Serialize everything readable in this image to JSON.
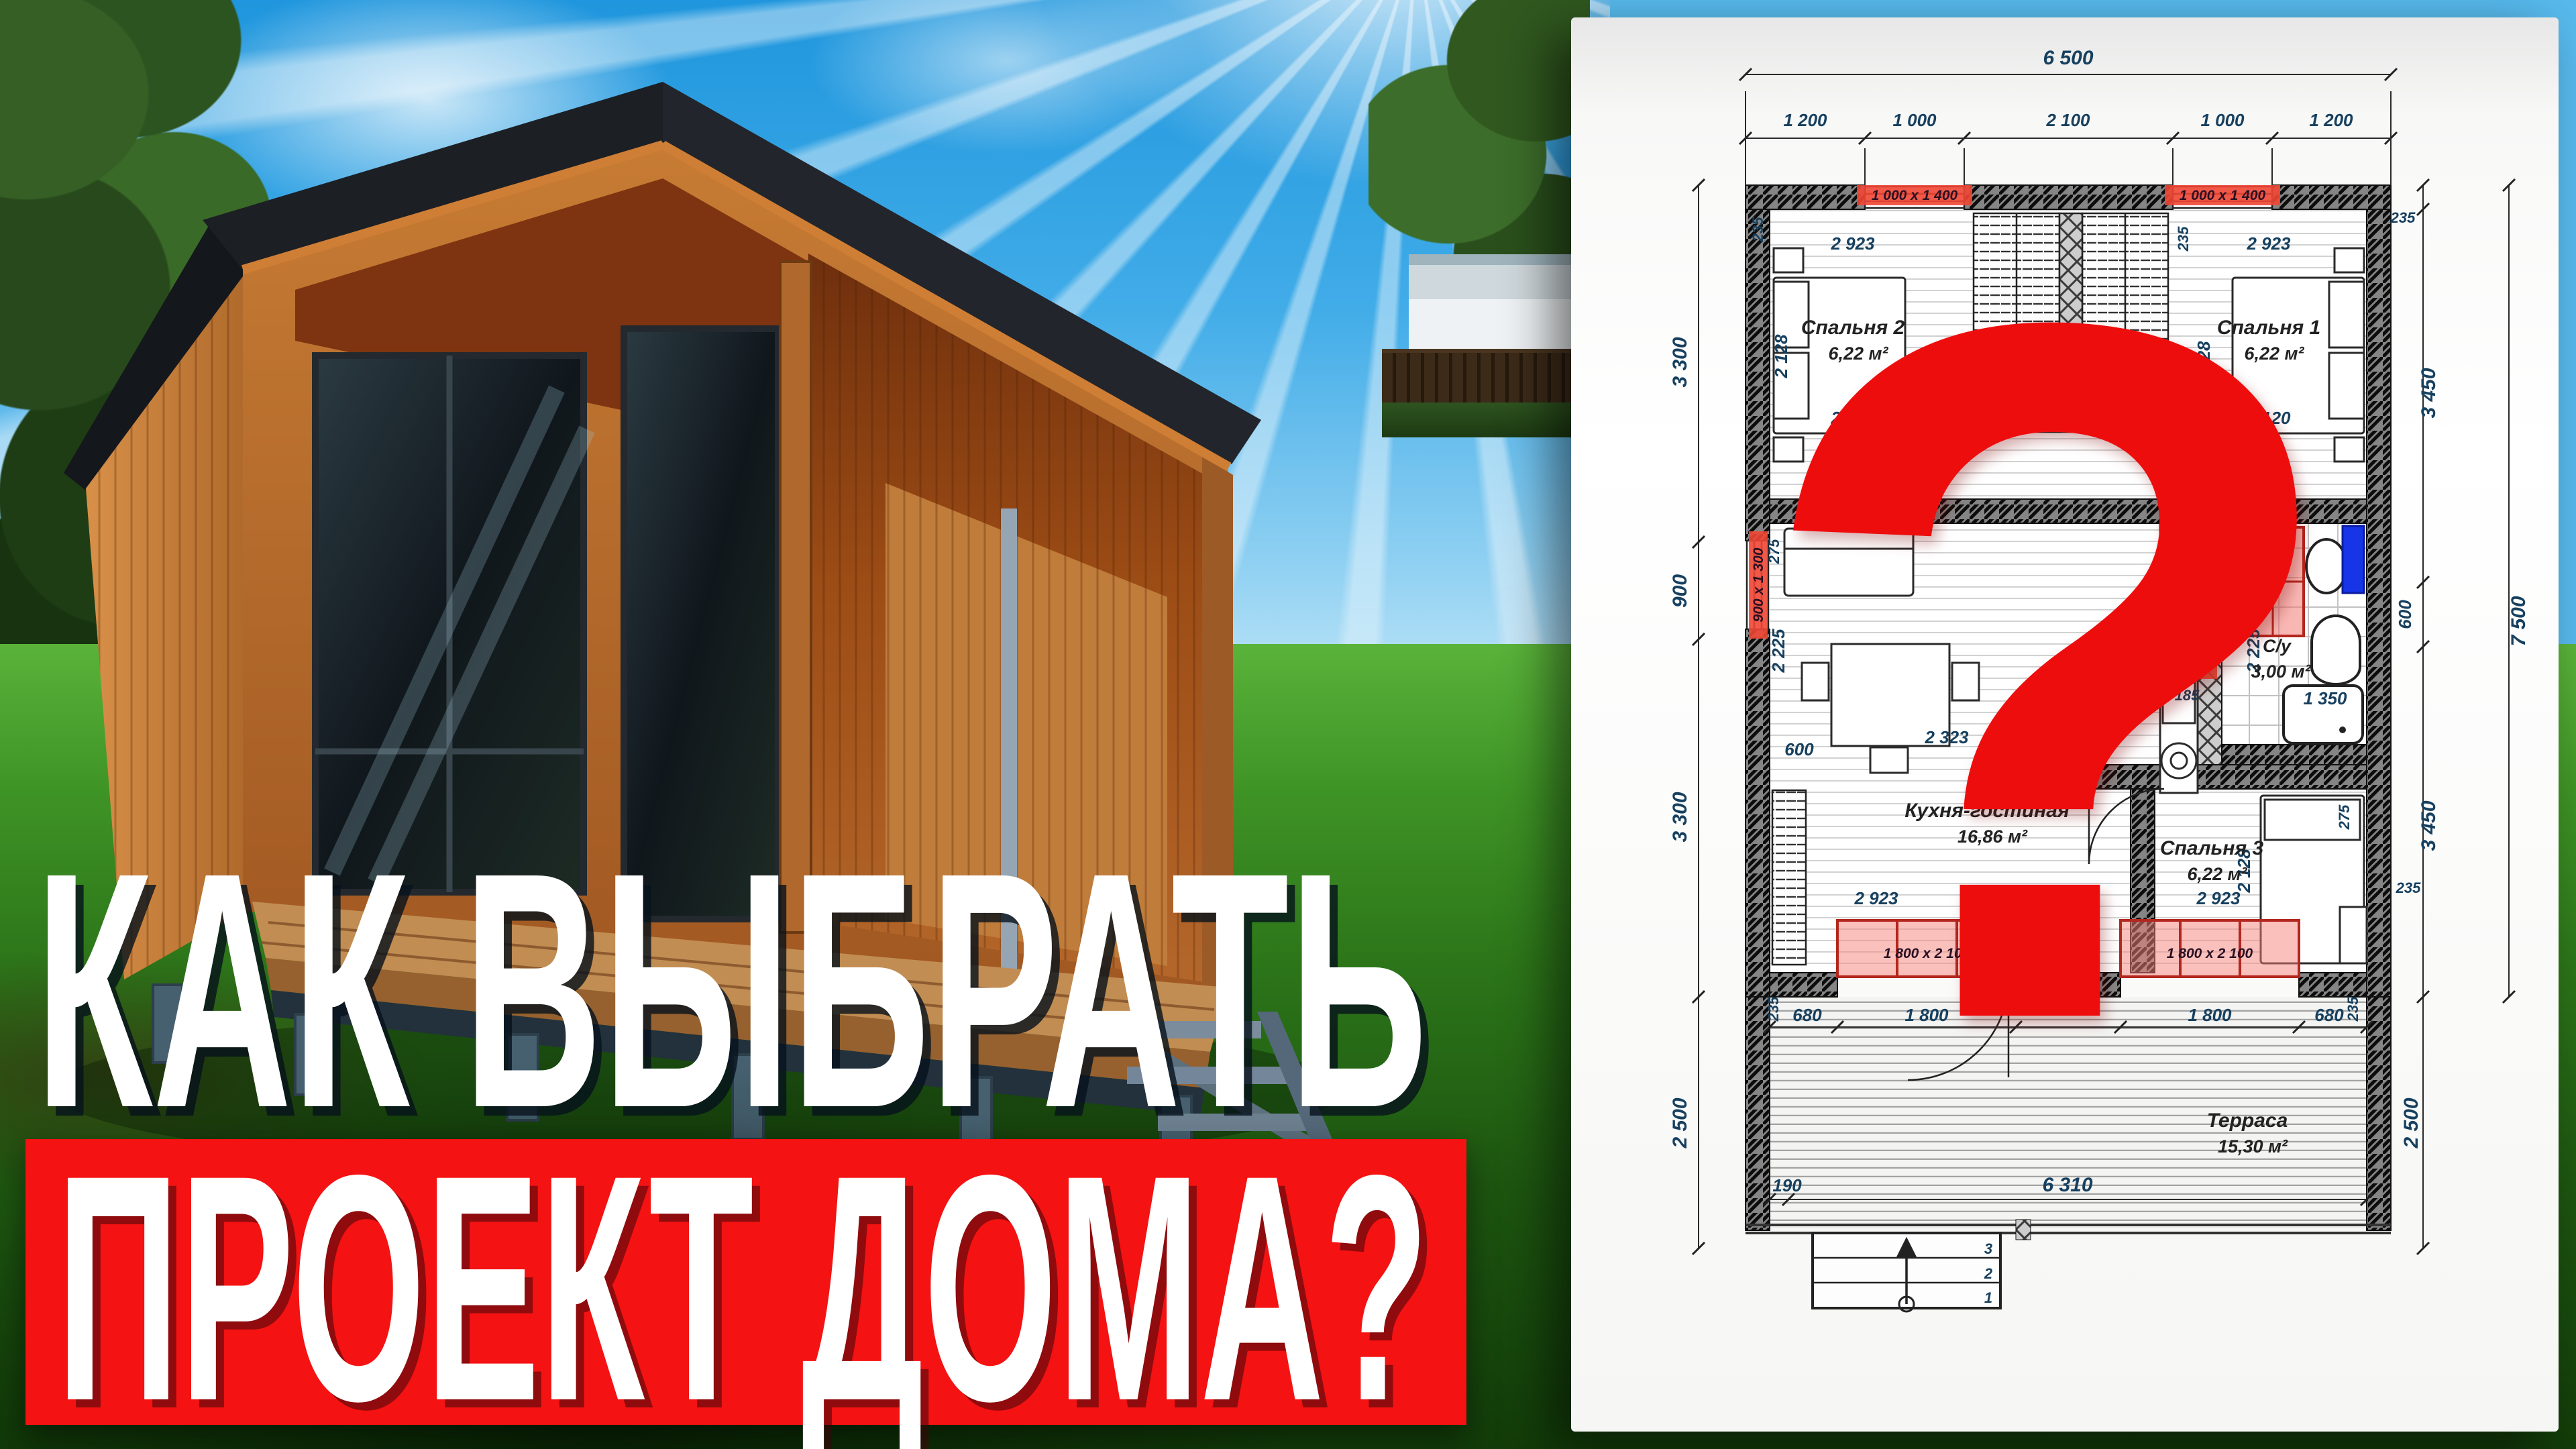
{
  "headline": {
    "line1": "КАК ВЫБРАТЬ",
    "line2": "ПРОЕКТ ДОМА?"
  },
  "question_mark": "?",
  "colors": {
    "banner_red": "#f41212",
    "question_red": "#ee0d0d",
    "highlight_pink": "#f08176",
    "fixture_blue": "#1734e6"
  },
  "plan": {
    "top_total": "6 500",
    "top_segments": [
      "1 200",
      "1 000",
      "2 100",
      "1 000",
      "1 200"
    ],
    "left_dims": [
      "3 300",
      "900",
      "3 300",
      "2 500"
    ],
    "right_dims": [
      "235",
      "3 450",
      "600",
      "3 450",
      "235",
      "2 500"
    ],
    "right_total": "7 500",
    "bottom_dims": [
      "190",
      "6 310"
    ],
    "terrace_dims": [
      "680",
      "1 800",
      "1 800",
      "680"
    ],
    "rooms": {
      "bedroom2": {
        "name": "Спальня 2",
        "area": "6,22 м²"
      },
      "bedroom1": {
        "name": "Спальня 1",
        "area": "6,22 м²"
      },
      "bedroom3": {
        "name": "Спальня 3",
        "area": "6,22 м²"
      },
      "kitchen": {
        "name": "Кухня-гостиная",
        "area": "16,86 м²"
      },
      "bath": {
        "name": "С/у",
        "area": "3,00 м²"
      },
      "terrace": {
        "name": "Терраса",
        "area": "15,30 м²"
      }
    },
    "dims": {
      "d235": "235",
      "d275": "275",
      "d2923": "2 923",
      "d2120": "2 120",
      "d2128": "2 128",
      "d2225": "2 225",
      "d600": "600",
      "d2323": "2 323",
      "d185": "185",
      "d1350": "1 350"
    },
    "window_labels": {
      "bedroom": "1 000 х 1 400",
      "kitchen": "900 х 1 300",
      "terrace_doors": "1 800 х 2 100",
      "bath_door": "700 х 2 070"
    },
    "stairs_steps": [
      "1",
      "2",
      "3"
    ]
  }
}
